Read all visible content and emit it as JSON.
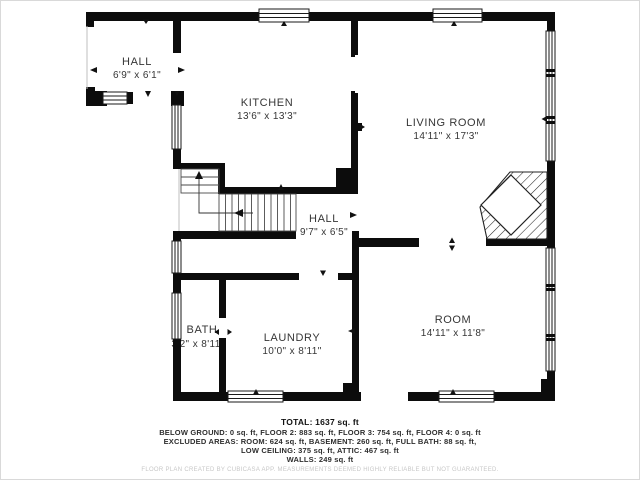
{
  "rooms": {
    "hall_top": {
      "name": "HALL",
      "dims": "6'9\" x 6'1\""
    },
    "kitchen": {
      "name": "KITCHEN",
      "dims": "13'6\" x 13'3\""
    },
    "living_room": {
      "name": "LIVING ROOM",
      "dims": "14'11\" x 17'3\""
    },
    "hall_mid": {
      "name": "HALL",
      "dims": "9'7\" x 6'5\""
    },
    "bath": {
      "name": "BATH",
      "dims": "3'2\" x 8'11\""
    },
    "laundry": {
      "name": "LAUNDRY",
      "dims": "10'0\" x 8'11\""
    },
    "room": {
      "name": "ROOM",
      "dims": "14'11\" x 11'8\""
    }
  },
  "summary": {
    "total": "TOTAL: 1637 sq. ft",
    "line1": "BELOW GROUND: 0 sq. ft, FLOOR 2: 883 sq. ft, FLOOR 3: 754 sq. ft, FLOOR 4: 0 sq. ft",
    "line2": "EXCLUDED AREAS: ROOM: 624 sq. ft, BASEMENT: 260 sq. ft, FULL BATH: 88 sq. ft,",
    "line3": "LOW CEILING: 375 sq. ft, ATTIC: 467 sq. ft",
    "line4": "WALLS: 249 sq. ft",
    "disclaimer": "FLOOR PLAN CREATED BY CUBICASA APP. MEASUREMENTS DEEMED HIGHLY RELIABLE BUT NOT GUARANTEED."
  },
  "colors": {
    "wall": "#0c0c0c",
    "background": "#ffffff",
    "disclaimer_text": "#c7c7c7"
  }
}
